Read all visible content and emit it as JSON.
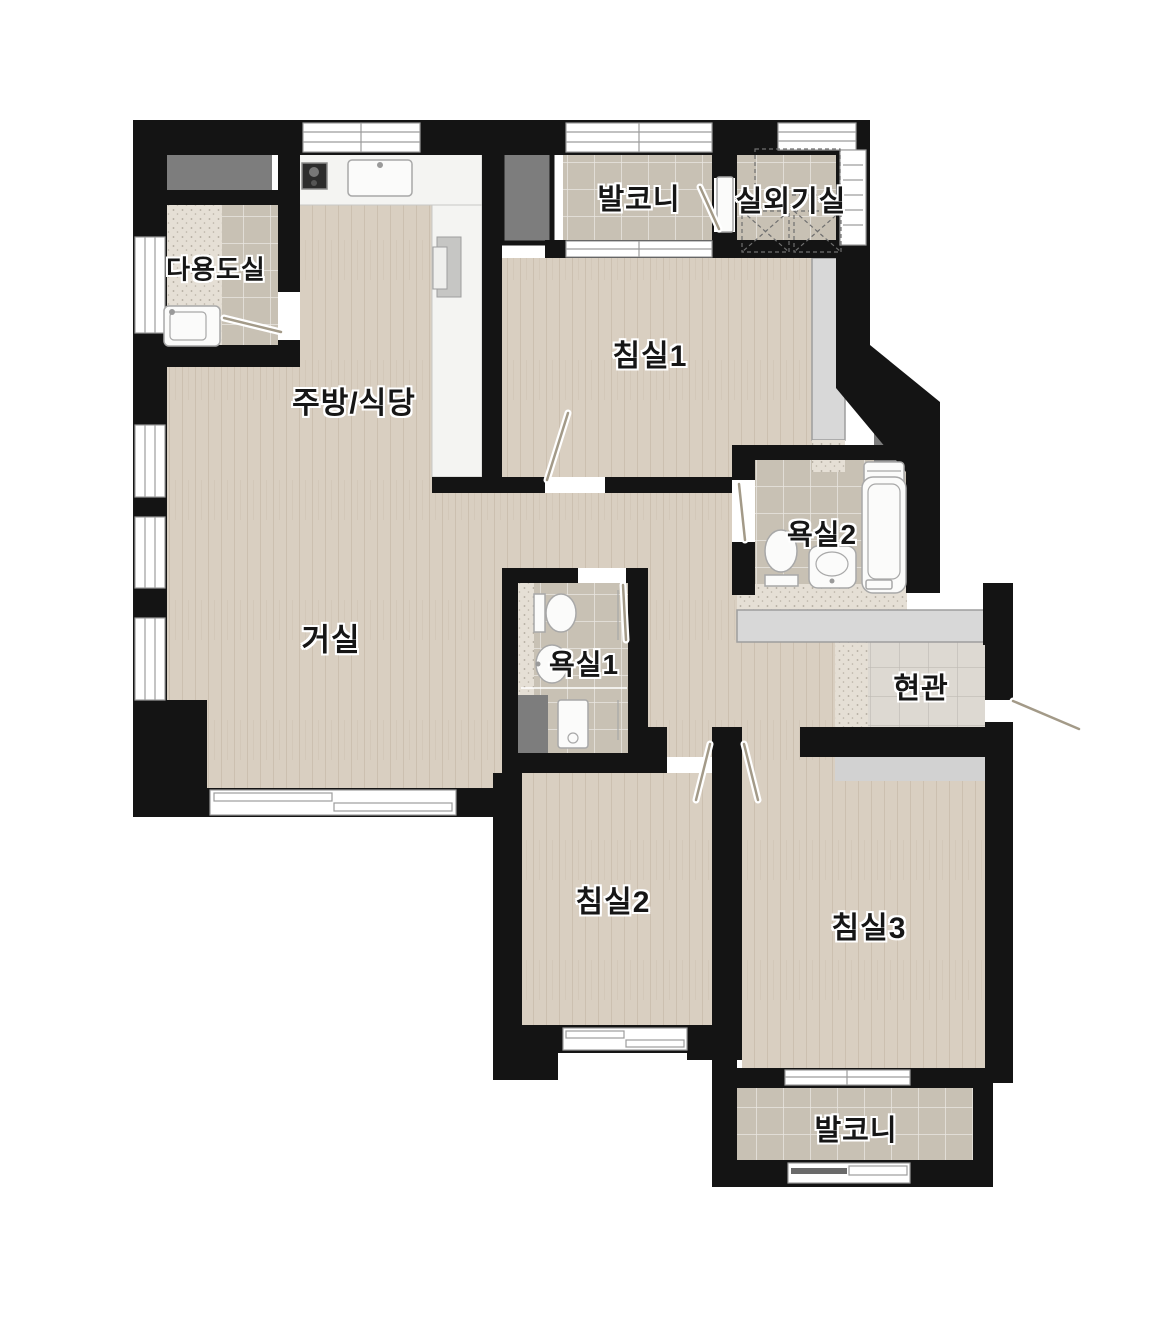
{
  "floorplan": {
    "title": "apartment-floor-plan",
    "rooms": {
      "utility": {
        "label": "다용도실"
      },
      "kitchen_dining": {
        "label": "주방/식당"
      },
      "balcony_top": {
        "label": "발코니"
      },
      "outdoor_unit": {
        "label": "실외기실"
      },
      "bedroom1": {
        "label": "침실1"
      },
      "bath2": {
        "label": "욕실2"
      },
      "living": {
        "label": "거실"
      },
      "bath1": {
        "label": "욕실1"
      },
      "entrance": {
        "label": "현관"
      },
      "bedroom2": {
        "label": "침실2"
      },
      "bedroom3": {
        "label": "침실3"
      },
      "balcony_bottom": {
        "label": "발코니"
      }
    },
    "colors": {
      "wall": "#141414",
      "wood": "#d9cfc1",
      "tile": "#c8c1b4",
      "entrance_tile": "#ddd9d2",
      "speckle": "#e5dfd5",
      "closet": "#d8d8d8",
      "sill": "#d2d2d2",
      "shaft": "#7d7d7d",
      "counter": "#f4f4f2",
      "fixture": "#fbfbfa"
    }
  }
}
